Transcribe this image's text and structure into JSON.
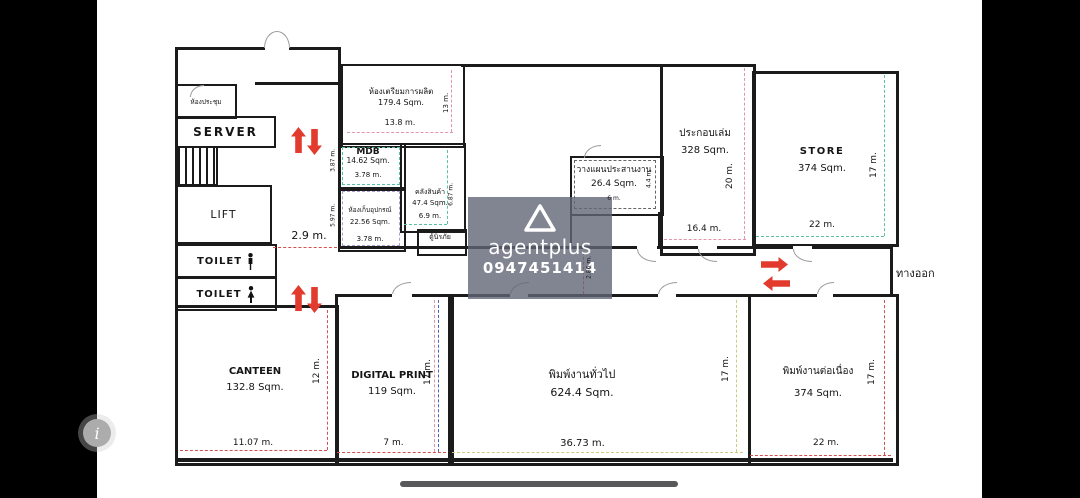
{
  "rooms": {
    "meeting": {
      "name": "ห้องประชุม"
    },
    "server": {
      "name": "SERVER"
    },
    "lift": {
      "name": "LIFT"
    },
    "toilet_m": {
      "name": "TOILET"
    },
    "toilet_f": {
      "name": "TOILET"
    },
    "prep": {
      "name": "ห้องเตรียมการผลิต",
      "area": "179.4 Sqm.",
      "w": "13.8 m.",
      "h": "13 m."
    },
    "mdb": {
      "name": "MDB",
      "area": "14.62 Sqm.",
      "w": "3.78 m.",
      "h": "3.87 m."
    },
    "equipment": {
      "name": "ห้องเก็บอุปกรณ์",
      "area": "22.56 Sqm.",
      "w": "3.78 m.",
      "h": "5.97 m."
    },
    "warehouse": {
      "name": "คลังสินค้า",
      "area": "47.4 Sqm.",
      "w": "6.9 m.",
      "h": "6.87 m."
    },
    "safe": {
      "name": "ตู้นิรภัย"
    },
    "planning": {
      "name": "วางแผนประสานงาน",
      "area": "26.4 Sqm.",
      "w": "6 m.",
      "h": "4.4 m."
    },
    "assembly": {
      "name": "ประกอบเล่ม",
      "area": "328 Sqm.",
      "w": "16.4 m.",
      "h": "20 m."
    },
    "store": {
      "name": "STORE",
      "area": "374 Sqm.",
      "w": "22 m.",
      "h": "17 m."
    },
    "canteen": {
      "name": "CANTEEN",
      "area": "132.8 Sqm.",
      "w": "11.07 m.",
      "h": "12 m."
    },
    "digital_print": {
      "name": "DIGITAL PRINT",
      "area": "119 Sqm.",
      "w": "7 m.",
      "h": "17 m."
    },
    "print_general": {
      "name": "พิมพ์งานทั่วไป",
      "area": "624.4 Sqm.",
      "w": "36.73 m.",
      "h": "17 m."
    },
    "print_continuous": {
      "name": "พิมพ์งานต่อเนื่อง",
      "area": "374 Sqm.",
      "w": "22 m.",
      "h": "17 m."
    }
  },
  "labels": {
    "hall_width": "2.9 m.",
    "corridor_width": "2.86 m.",
    "exit": "ทางออก"
  },
  "watermark": {
    "brand": "agentplus",
    "phone": "0947451414"
  },
  "system": {
    "info_label": "i"
  },
  "colors": {
    "wall": "#1b1b1b",
    "arrow": "#e23b2e",
    "watermark_bg": "#606776",
    "dash_pink": "#e394a6",
    "dash_red": "#d45050",
    "dash_teal": "#58c0a4",
    "dash_violet": "#b09ed6",
    "dash_blue": "#4a5fc0",
    "dash_olive": "#cfcb7e"
  }
}
